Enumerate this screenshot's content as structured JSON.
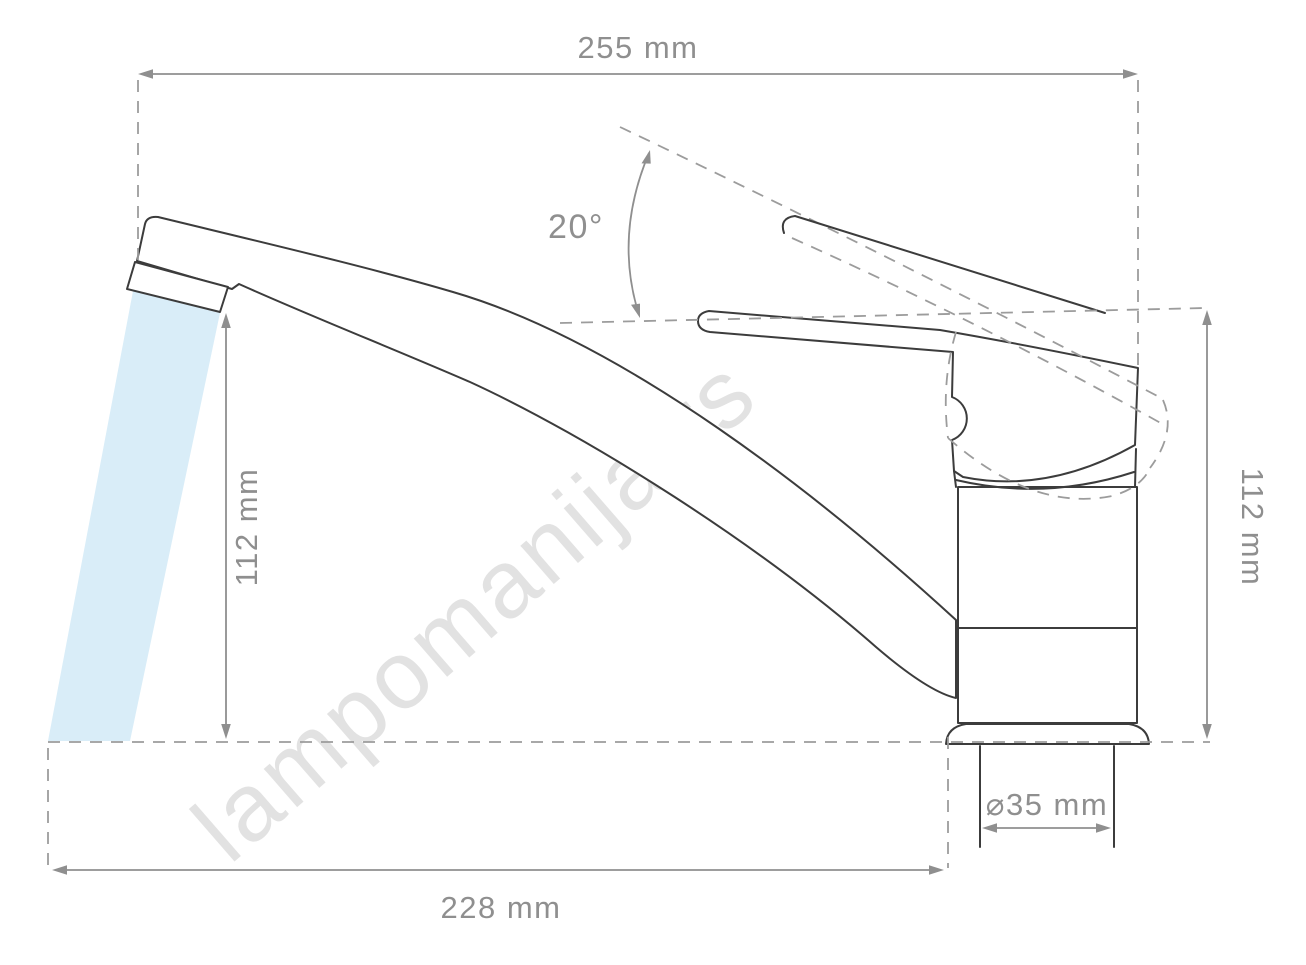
{
  "drawing": {
    "subject": "single-lever-faucet-side-view",
    "watermark": "lampomanija.rs",
    "labels": {
      "width_top": "255 mm",
      "angle": "20°",
      "height_left": "112 mm",
      "height_right": "112 mm",
      "width_bottom": "228 mm",
      "diameter": "⌀35 mm"
    },
    "colors": {
      "outline": "#3c3c3c",
      "dimension": "#8f8f8f",
      "dashed": "#9c9c9c",
      "water": "#d9edf8",
      "watermark": "#cbcbcb",
      "background": "#ffffff"
    }
  }
}
